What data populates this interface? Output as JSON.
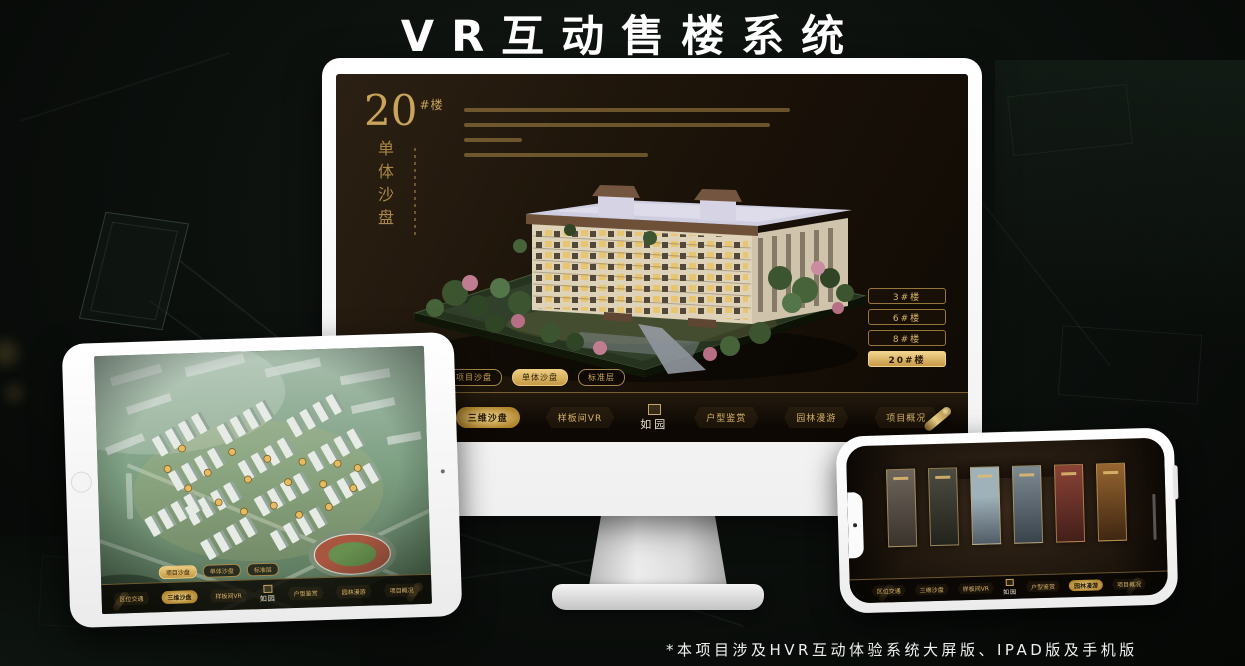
{
  "title": "VR互动售楼系统",
  "footnote": "*本项目涉及HVR互动体验系统大屏版、IPAD版及手机版",
  "colors": {
    "gold": "#c9a45c",
    "gold_bright": "#edcb7f",
    "screen_bg": "#1c1309",
    "page_bg": "#0b0e0c"
  },
  "monitor": {
    "headline": {
      "number": "20",
      "suffix": "#楼",
      "vertical": "单体沙盘"
    },
    "building_buttons": [
      {
        "label": "3#楼",
        "selected": false
      },
      {
        "label": "6#楼",
        "selected": false
      },
      {
        "label": "8#楼",
        "selected": false
      },
      {
        "label": "20#楼",
        "selected": true
      }
    ],
    "sub_tabs": [
      {
        "label": "项目沙盘",
        "selected": false
      },
      {
        "label": "单体沙盘",
        "selected": true
      },
      {
        "label": "标准层",
        "selected": false
      }
    ],
    "nav_left": [
      {
        "label": "区位交通",
        "selected": false
      },
      {
        "label": "三维沙盘",
        "selected": true
      },
      {
        "label": "样板间VR",
        "selected": false
      }
    ],
    "nav_right": [
      {
        "label": "户型鉴赏",
        "selected": false
      },
      {
        "label": "园林漫游",
        "selected": false
      },
      {
        "label": "项目概况",
        "selected": false
      }
    ],
    "logo": "如园"
  },
  "tablet": {
    "sub_tabs": [
      {
        "label": "项目沙盘",
        "selected": true
      },
      {
        "label": "单体沙盘",
        "selected": false
      },
      {
        "label": "标准层",
        "selected": false
      }
    ],
    "nav_left": [
      {
        "label": "区位交通",
        "selected": false
      },
      {
        "label": "三维沙盘",
        "selected": true
      },
      {
        "label": "样板间VR",
        "selected": false
      }
    ],
    "nav_right": [
      {
        "label": "户型鉴赏",
        "selected": false
      },
      {
        "label": "园林漫游",
        "selected": false
      },
      {
        "label": "项目概况",
        "selected": false
      }
    ],
    "logo": "如园"
  },
  "phone": {
    "nav_left": [
      {
        "label": "区位交通",
        "selected": false
      },
      {
        "label": "三维沙盘",
        "selected": false
      },
      {
        "label": "样板间VR",
        "selected": false
      }
    ],
    "nav_right": [
      {
        "label": "户型鉴赏",
        "selected": false
      },
      {
        "label": "园林漫游",
        "selected": true
      },
      {
        "label": "项目概况",
        "selected": false
      }
    ],
    "logo": "如园"
  }
}
